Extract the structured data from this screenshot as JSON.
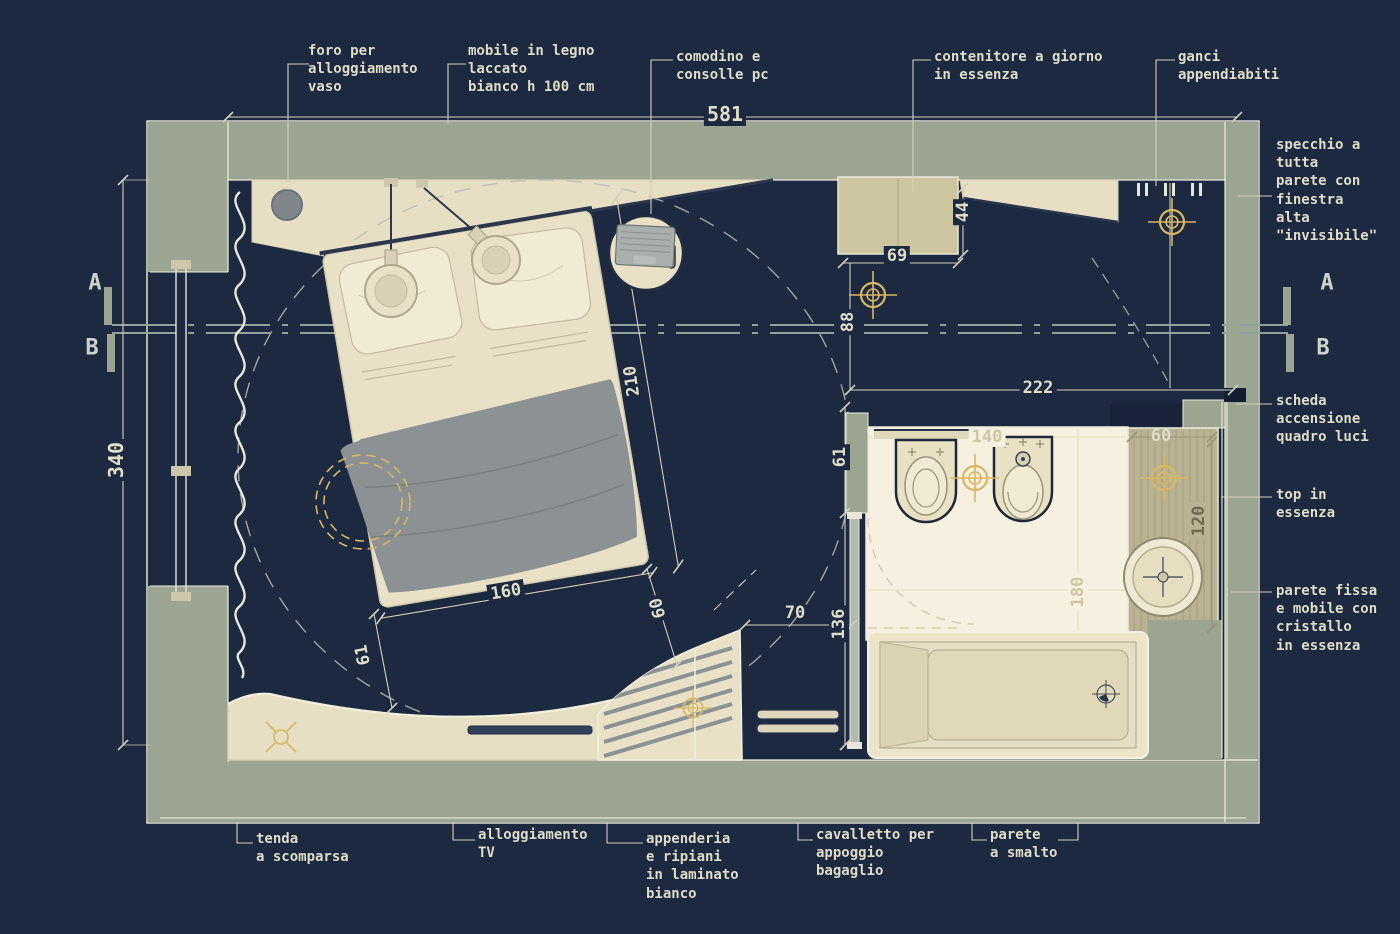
{
  "title": "camera con bagno - pianta quotata",
  "colors": {
    "background": "#1c2940",
    "wall": "#9ba592",
    "furniture_cream": "#e9e1c6",
    "container_tan": "#cdc59f",
    "bathroom_floor": "#f5f0e0",
    "blanket_gray": "#8c9293",
    "dimension_text": "#e0ddc8",
    "gold_accent": "#d9b662"
  },
  "labels": {
    "foro_vaso": "foro per\nalloggiamento\nvaso",
    "mobile_legno": "mobile in legno\nlaccato\nbianco  h 100 cm",
    "comodino": "comodino e\nconsolle pc",
    "contenitore": "contenitore a giorno\nin essenza",
    "ganci": "ganci\nappendiabiti",
    "specchio": "specchio a\ntutta\nparete con\nfinestra\nalta\n\"invisibile\"",
    "scheda": "scheda\naccensione\nquadro luci",
    "top_essenza": "top in\nessenza",
    "parete_fissa": "parete fissa\ne mobile  con\ncristallo\nin essenza",
    "tenda": "tenda\na scomparsa",
    "tv": "alloggiamento\nTV",
    "appenderia": "appenderia\ne ripiani\nin laminato\nbianco",
    "cavalletto": "cavalletto per\nappoggio\nbagaglio",
    "parete_smalto": "parete\na smalto"
  },
  "dimensions": {
    "total_w": "581",
    "total_h": "340",
    "container_w": "69",
    "container_d": "44",
    "dist_88": "88",
    "bath_w": "222",
    "niche_61": "61",
    "door_136": "136",
    "opening_70": "70",
    "bath_140": "140",
    "bath_180": "180",
    "top_60": "60",
    "top_120": "120",
    "bed_l": "210",
    "bed_w": "160",
    "bed_60": "60",
    "bed_61": "61"
  },
  "sections": {
    "a": "A",
    "b": "B"
  }
}
